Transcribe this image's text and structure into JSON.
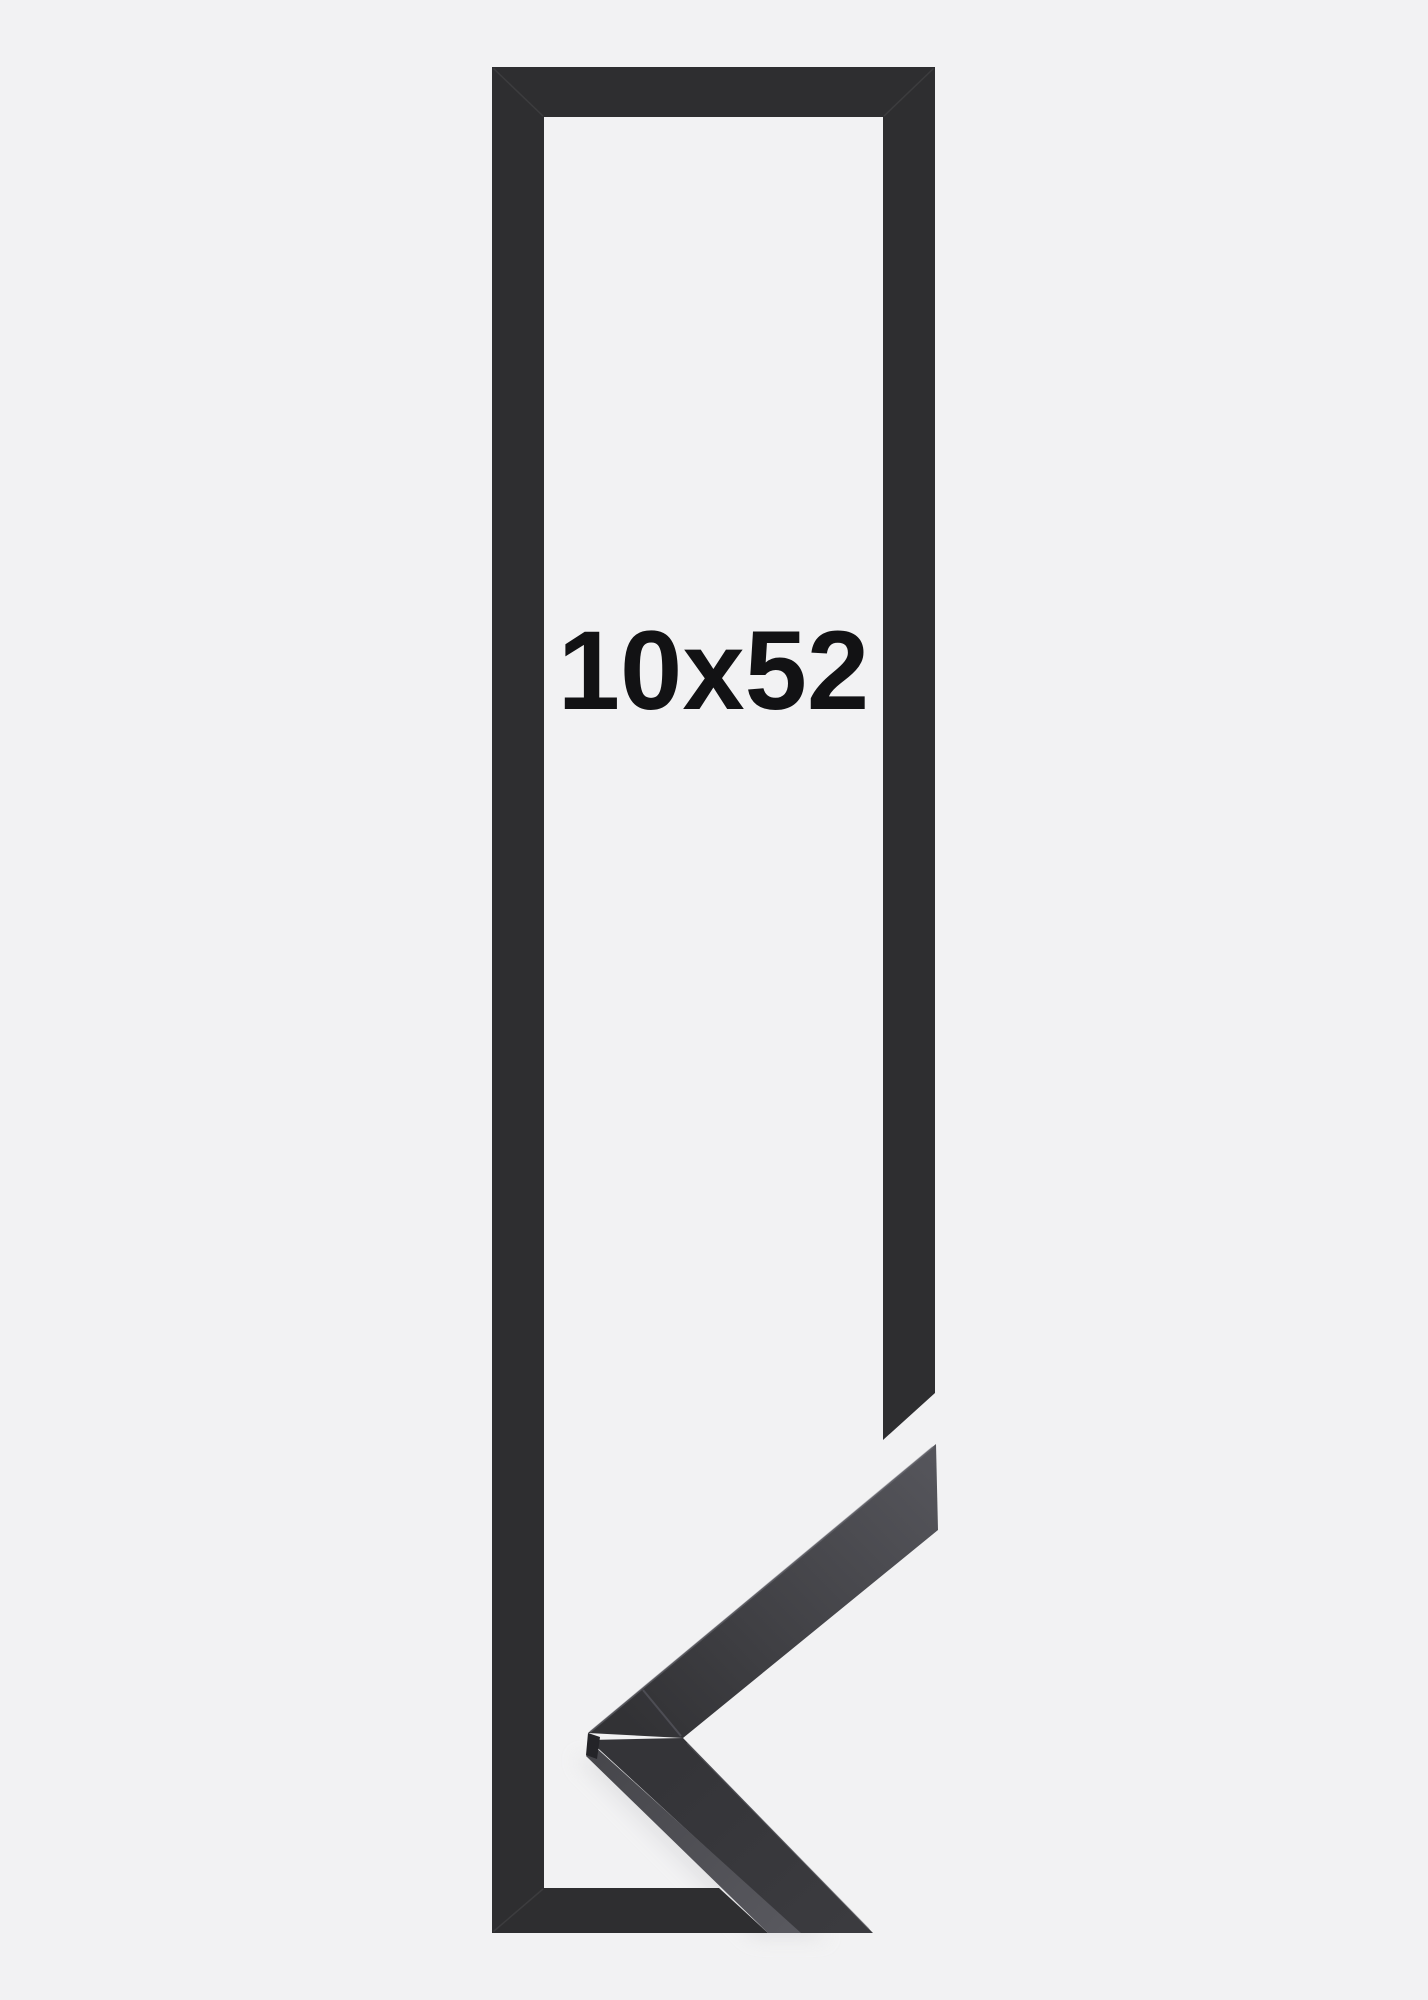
{
  "page": {
    "background_color": "#f2f2f3"
  },
  "product": {
    "size_label": "10x52",
    "label_color": "#121214",
    "description": "black-frame-with-corner-sample"
  },
  "colors": {
    "frame": "#2e2e30",
    "frame_seam": "#48484a",
    "shadow": "#dcdcde",
    "sample_tip_light": "#55555b",
    "sample_upper_dark": "#323235",
    "sample_lower_main": "#343438",
    "sample_lower_main2": "#3b3b3f",
    "sample_strip_dark": "#47474c",
    "sample_strip_light": "#58585e",
    "sample_facet": "#242428",
    "sample_edge_highlight": "#74747c",
    "sample_miter_seam": "#54545b"
  }
}
